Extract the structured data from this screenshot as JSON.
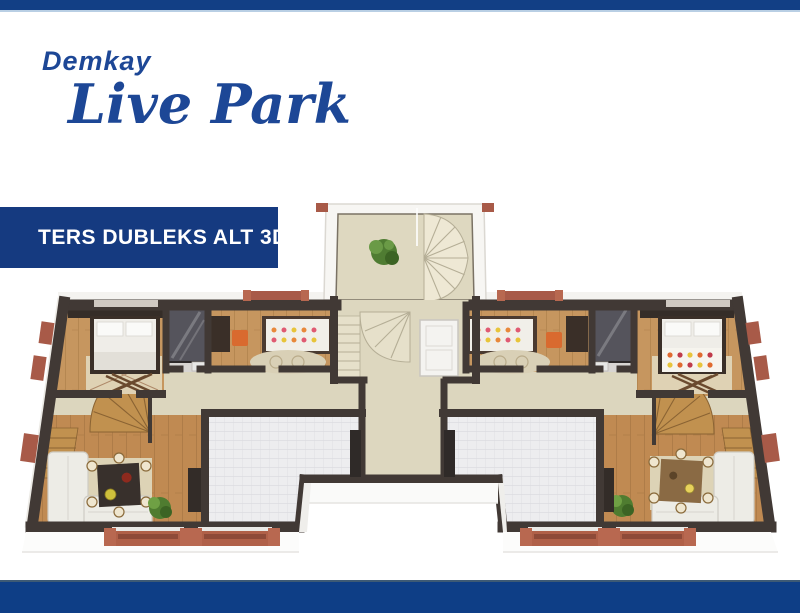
{
  "brand": {
    "name_line1": "Demkay",
    "name_line2": "Live Park",
    "color": "#1d4796"
  },
  "banner": {
    "label": "TERS DUBLEKS ALT 3D",
    "bg_color": "#153a80",
    "text_color": "#ffffff"
  },
  "bars": {
    "top_color": "#123f85",
    "bottom_color": "#0e3e86",
    "accent_line_color": "#b9cfe4"
  },
  "floorplan": {
    "type": "3d-floor-plan-render",
    "rooms": [
      "bedroom-left",
      "bathroom-left",
      "kids-room-left",
      "central-stairwell",
      "kids-room-right",
      "bathroom-right",
      "bedroom-right",
      "hall-left",
      "hall-center",
      "hall-right",
      "living-room-left",
      "tile-room-left",
      "tile-room-right",
      "living-room-right",
      "unit-stair-left",
      "unit-stair-right"
    ],
    "balcony_count": 4,
    "colors": {
      "wall": "#413935",
      "wood_floor": "#c6965f",
      "hall_floor": "#dcd6be",
      "tile_floor": "#ededef",
      "brick_accent": "#a85a48",
      "sofa": "#edece6",
      "plant": "#4f7c30",
      "shower": "#55545c",
      "chair_orange": "#d96a2f"
    }
  }
}
